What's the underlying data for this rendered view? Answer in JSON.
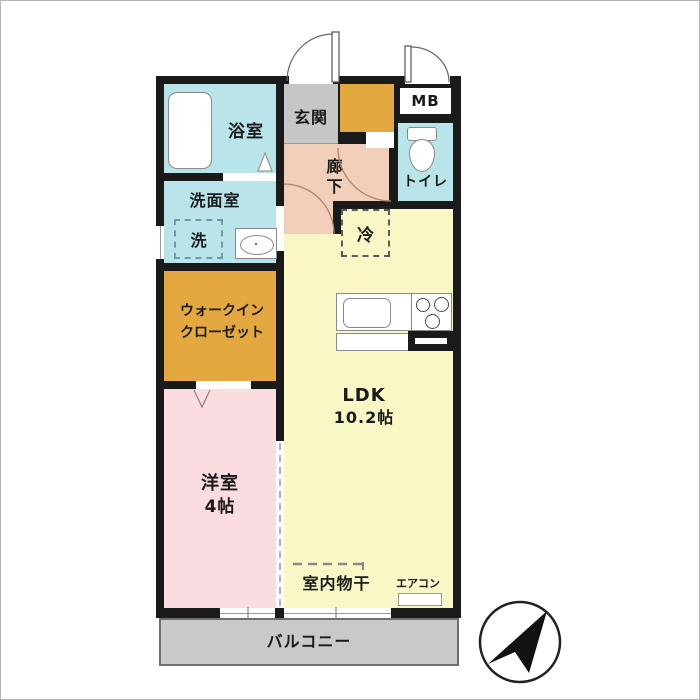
{
  "plan": {
    "title_semantic": "japanese-apartment-floor-plan",
    "bathroom": {
      "label": "浴室"
    },
    "washroom": {
      "label": "洗面室",
      "washer": "洗"
    },
    "entrance": {
      "label": "玄関"
    },
    "meter_box": {
      "label": "MB"
    },
    "toilet": {
      "label": "トイレ"
    },
    "corridor": {
      "line1": "廊",
      "line2": "下"
    },
    "wic": {
      "line1": "ウォークイン",
      "line2": "クローゼット"
    },
    "ldk": {
      "label": "LDK",
      "size": "10.2帖",
      "fridge": "冷"
    },
    "bedroom": {
      "label": "洋室",
      "size": "4帖"
    },
    "balcony": {
      "label": "バルコニー"
    },
    "notes": {
      "indoor_drying": "室内物干",
      "aircon": "エアコン"
    },
    "icons": {
      "bathtub": "bathtub-icon",
      "toilet": "toilet-icon",
      "sink": "sink-icon",
      "kitchen_sink": "kitchen-sink-icon",
      "stove": "stove-burners-icon",
      "compass": "north-compass-icon",
      "door_arcs": "door-swing-arc"
    },
    "colors": {
      "wall": "#1a1a1a",
      "wet_area_cyan": "#b8e4ea",
      "corridor_peach": "#f1cfba",
      "storage_orange": "#e3a83f",
      "entrance_gray": "#c6c6c6",
      "ldk_yellow": "#f8f7c5",
      "bedroom_pink": "#fbdce0",
      "balcony_gray": "#c9c9c9"
    }
  }
}
